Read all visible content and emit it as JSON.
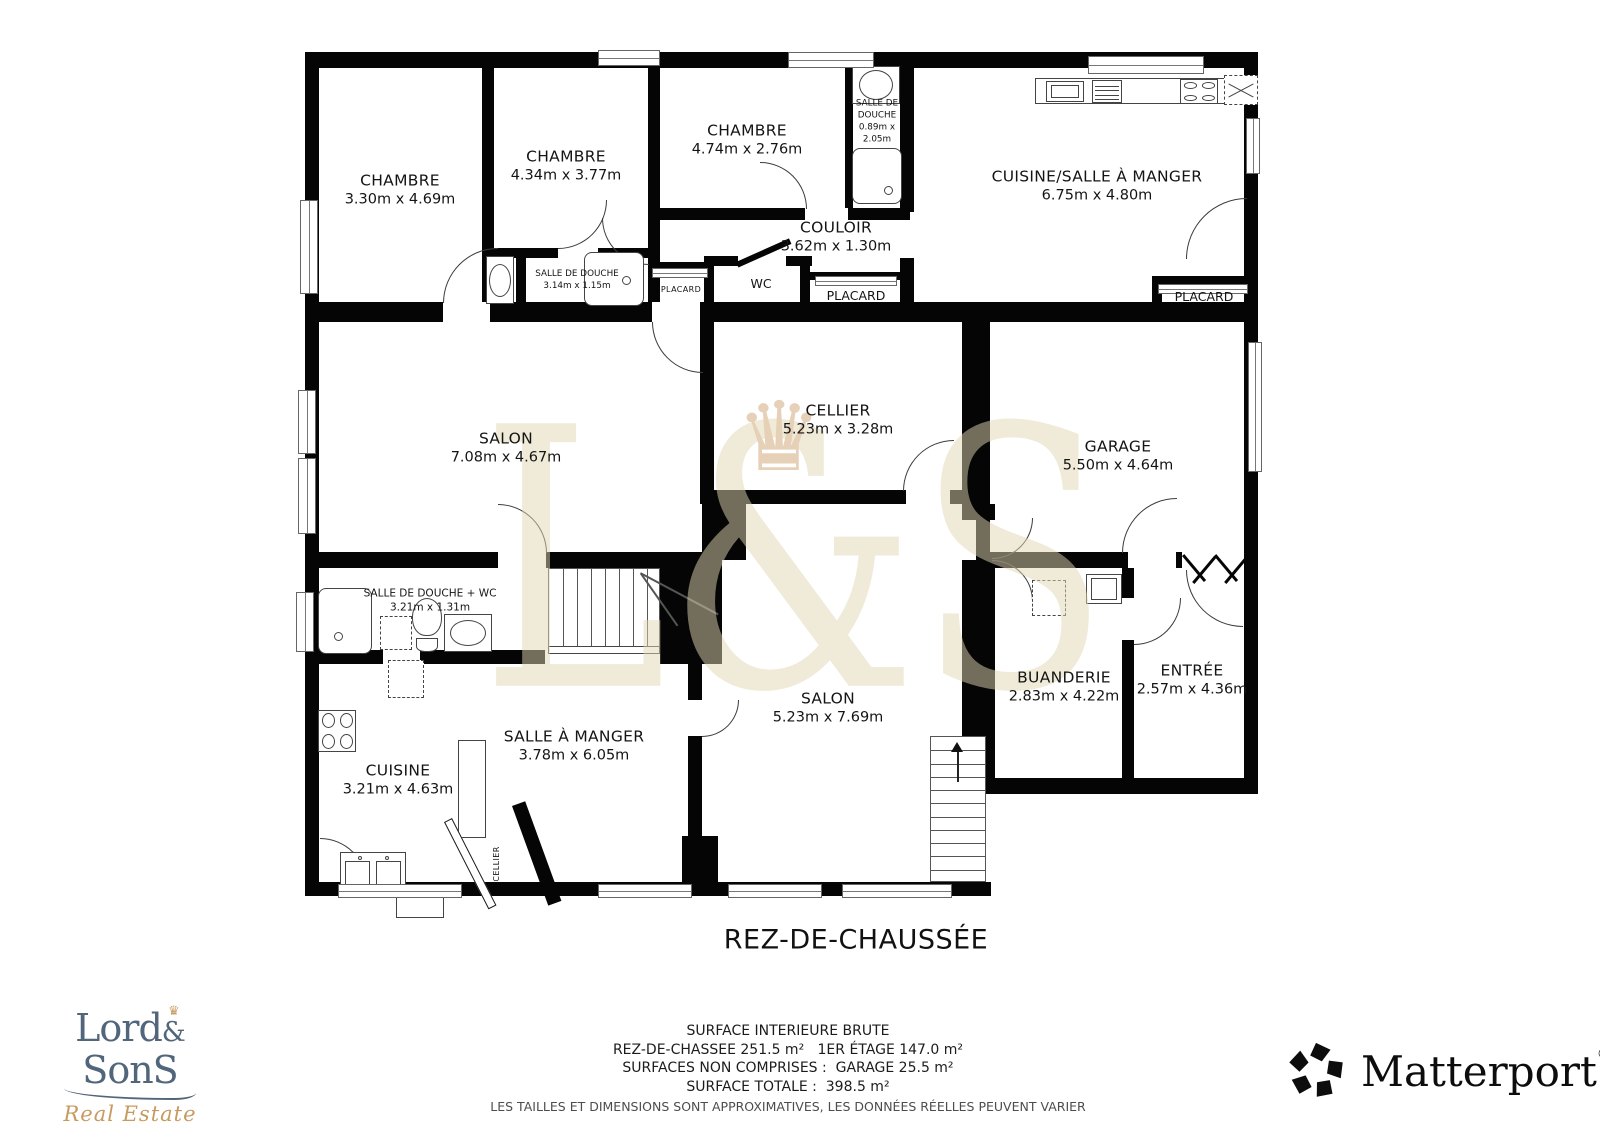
{
  "title": "REZ-DE-CHAUSSÉE",
  "watermark": {
    "text": "L&S",
    "crown_glyph": "♛"
  },
  "footer": {
    "line1": "SURFACE INTERIEURE BRUTE",
    "line2": "REZ-DE-CHASSEE 251.5 m²   1ER ÉTAGE 147.0 m²",
    "line3": "SURFACES NON COMPRISES :  GARAGE 25.5 m²",
    "line4": "SURFACE TOTALE :  398.5 m²",
    "disclaimer": "LES TAILLES ET DIMENSIONS SONT APPROXIMATIVES, LES DONNÉES RÉELLES PEUVENT VARIER"
  },
  "logos": {
    "lordsons": {
      "part1": "Lord",
      "amp": "&",
      "part2": "SonS",
      "tagline": "Real Estate",
      "crown_glyph": "♛",
      "color": "#51657b",
      "gold": "#c79b5f"
    },
    "matterport": {
      "label": "Matterport",
      "reg": "®",
      "color": "#0d0d0d"
    }
  },
  "rooms": [
    {
      "name": "CHAMBRE",
      "dims": "3.30m x 4.69m",
      "x": 400,
      "y": 190,
      "size": "md"
    },
    {
      "name": "CHAMBRE",
      "dims": "4.34m x 3.77m",
      "x": 566,
      "y": 166,
      "size": "md"
    },
    {
      "name": "CHAMBRE",
      "dims": "4.74m x 2.76m",
      "x": 747,
      "y": 140,
      "size": "md"
    },
    {
      "name": "SALLE DE DOUCHE",
      "dims": "0.89m x 2.05m",
      "x": 877,
      "y": 122,
      "size": "xs",
      "w": 56
    },
    {
      "name": "CUISINE/SALLE À MANGER",
      "dims": "6.75m x 4.80m",
      "x": 1097,
      "y": 186,
      "size": "md"
    },
    {
      "name": "COULOIR",
      "dims": "3.62m x 1.30m",
      "x": 836,
      "y": 237,
      "size": "md"
    },
    {
      "name": "WC",
      "dims": "",
      "x": 761,
      "y": 284,
      "size": "sm"
    },
    {
      "name": "PLACARD",
      "dims": "",
      "x": 681,
      "y": 290,
      "size": "xxs"
    },
    {
      "name": "PLACARD",
      "dims": "",
      "x": 856,
      "y": 296,
      "size": "sm"
    },
    {
      "name": "PLACARD",
      "dims": "",
      "x": 1204,
      "y": 297,
      "size": "sm"
    },
    {
      "name": "SALLE DE DOUCHE",
      "dims": "3.14m x 1.15m",
      "x": 577,
      "y": 281,
      "size": "xs"
    },
    {
      "name": "SALON",
      "dims": "7.08m x 4.67m",
      "x": 506,
      "y": 448,
      "size": "md"
    },
    {
      "name": "CELLIER",
      "dims": "5.23m x 3.28m",
      "x": 838,
      "y": 420,
      "size": "md"
    },
    {
      "name": "GARAGE",
      "dims": "5.50m x 4.64m",
      "x": 1118,
      "y": 456,
      "size": "md"
    },
    {
      "name": "SALLE DE DOUCHE + WC",
      "dims": "3.21m x 1.31m",
      "x": 430,
      "y": 601,
      "size": "xsp"
    },
    {
      "name": "CUISINE",
      "dims": "3.21m x 4.63m",
      "x": 398,
      "y": 780,
      "size": "md"
    },
    {
      "name": "SALLE À MANGER",
      "dims": "3.78m x 6.05m",
      "x": 574,
      "y": 746,
      "size": "md"
    },
    {
      "name": "SALON",
      "dims": "5.23m x 7.69m",
      "x": 828,
      "y": 708,
      "size": "md"
    },
    {
      "name": "BUANDERIE",
      "dims": "2.83m x 4.22m",
      "x": 1064,
      "y": 687,
      "size": "md"
    },
    {
      "name": "ENTRÉE",
      "dims": "2.57m x 4.36m",
      "x": 1192,
      "y": 680,
      "size": "md"
    },
    {
      "name": "CELLIER",
      "dims": "",
      "x": 497,
      "y": 864,
      "size": "xxs",
      "rot": -90
    }
  ],
  "plan": {
    "walls": [
      [
        305,
        52,
        953,
        16
      ],
      [
        305,
        52,
        14,
        844
      ],
      [
        1244,
        52,
        14,
        516
      ],
      [
        1244,
        568,
        14,
        226
      ],
      [
        305,
        882,
        686,
        14
      ],
      [
        995,
        778,
        263,
        16
      ],
      [
        305,
        302,
        138,
        20
      ],
      [
        490,
        302,
        162,
        20
      ],
      [
        700,
        302,
        558,
        20
      ],
      [
        482,
        52,
        12,
        250
      ],
      [
        648,
        52,
        12,
        250
      ],
      [
        900,
        52,
        14,
        160
      ],
      [
        900,
        258,
        14,
        44
      ],
      [
        845,
        52,
        8,
        156
      ],
      [
        660,
        208,
        145,
        12
      ],
      [
        848,
        208,
        62,
        12
      ],
      [
        704,
        256,
        34,
        10
      ],
      [
        786,
        256,
        26,
        10
      ],
      [
        704,
        256,
        10,
        50
      ],
      [
        800,
        256,
        10,
        50
      ],
      [
        648,
        262,
        60,
        8
      ],
      [
        810,
        272,
        90,
        8
      ],
      [
        1152,
        276,
        106,
        8
      ],
      [
        1152,
        276,
        10,
        36
      ],
      [
        482,
        248,
        76,
        10
      ],
      [
        598,
        248,
        50,
        10
      ],
      [
        516,
        252,
        10,
        54
      ],
      [
        700,
        322,
        14,
        180
      ],
      [
        962,
        322,
        14,
        182
      ],
      [
        700,
        490,
        206,
        14
      ],
      [
        950,
        490,
        26,
        14
      ],
      [
        976,
        322,
        14,
        246
      ],
      [
        976,
        552,
        152,
        16
      ],
      [
        1176,
        552,
        6,
        16
      ],
      [
        1244,
        552,
        14,
        16
      ],
      [
        702,
        502,
        44,
        58
      ],
      [
        305,
        552,
        193,
        16
      ],
      [
        546,
        552,
        162,
        16
      ],
      [
        676,
        552,
        46,
        112
      ],
      [
        688,
        560,
        14,
        140
      ],
      [
        688,
        736,
        14,
        146
      ],
      [
        682,
        836,
        36,
        46
      ],
      [
        305,
        650,
        78,
        14
      ],
      [
        420,
        650,
        125,
        14
      ],
      [
        660,
        552,
        16,
        112
      ],
      [
        962,
        504,
        33,
        16
      ],
      [
        962,
        560,
        33,
        234
      ],
      [
        962,
        794,
        14,
        88
      ],
      [
        1122,
        568,
        12,
        30
      ],
      [
        1122,
        640,
        12,
        138
      ]
    ],
    "windows": [
      [
        598,
        50,
        60,
        14,
        "h"
      ],
      [
        788,
        52,
        84,
        14,
        "h"
      ],
      [
        1088,
        56,
        114,
        16,
        "h"
      ],
      [
        300,
        200,
        16,
        92,
        "v"
      ],
      [
        298,
        390,
        16,
        62,
        "v"
      ],
      [
        298,
        458,
        16,
        74,
        "v"
      ],
      [
        1246,
        118,
        12,
        54,
        "v"
      ],
      [
        1248,
        342,
        12,
        128,
        "v"
      ],
      [
        338,
        884,
        122,
        12,
        "h"
      ],
      [
        598,
        884,
        92,
        12,
        "h"
      ],
      [
        728,
        884,
        92,
        12,
        "h"
      ],
      [
        842,
        884,
        108,
        12,
        "h"
      ],
      [
        296,
        592,
        16,
        58,
        "v"
      ],
      [
        652,
        268,
        54,
        8,
        "h"
      ],
      [
        815,
        276,
        80,
        8,
        "h"
      ],
      [
        1158,
        284,
        88,
        8,
        "h"
      ]
    ],
    "doors": [
      [
        443,
        248,
        54,
        "tl"
      ],
      [
        558,
        200,
        48,
        "br"
      ],
      [
        760,
        162,
        46,
        "tr"
      ],
      [
        602,
        218,
        46,
        "bl"
      ],
      [
        1186,
        198,
        60,
        "tl"
      ],
      [
        903,
        440,
        50,
        "tl"
      ],
      [
        1122,
        498,
        54,
        "tl"
      ],
      [
        498,
        504,
        48,
        "tr"
      ],
      [
        992,
        518,
        40,
        "br"
      ],
      [
        992,
        560,
        40,
        "tr"
      ],
      [
        1186,
        570,
        56,
        "bl"
      ],
      [
        1134,
        598,
        46,
        "br"
      ],
      [
        320,
        838,
        46,
        "tr"
      ],
      [
        702,
        700,
        36,
        "br"
      ],
      [
        652,
        322,
        50,
        "bl"
      ]
    ],
    "leaves": [
      [
        736,
        262,
        58,
        6,
        -24,
        "b"
      ],
      [
        512,
        806,
        14,
        106,
        -20,
        "b"
      ],
      [
        452,
        818,
        96,
        7,
        63,
        "o"
      ],
      [
        640,
        574,
        2,
        64,
        -35,
        "g"
      ],
      [
        640,
        574,
        2,
        88,
        -62,
        "g"
      ],
      [
        1182,
        556,
        3,
        34,
        -40,
        "b"
      ],
      [
        1214,
        556,
        3,
        34,
        40,
        "b"
      ],
      [
        1214,
        556,
        3,
        34,
        -40,
        "b"
      ],
      [
        1246,
        556,
        3,
        34,
        40,
        "b"
      ]
    ],
    "stairs": [
      {
        "x": 548,
        "y": 568,
        "w": 112,
        "h": 80,
        "dir": "v",
        "treads": 7
      },
      {
        "x": 930,
        "y": 736,
        "w": 56,
        "h": 146,
        "dir": "h",
        "treads": 10
      }
    ],
    "fixtures": [
      [
        "rect",
        1035,
        78,
        212,
        26
      ],
      [
        "washer",
        1046,
        81,
        38,
        21
      ],
      [
        "grill",
        1092,
        80,
        30,
        23
      ],
      [
        "hob",
        1180,
        79,
        38,
        25
      ],
      [
        "dashedx",
        1224,
        75,
        34,
        30
      ],
      [
        "rect",
        852,
        66,
        48,
        38
      ],
      [
        "ellipse",
        859,
        70,
        34,
        30
      ],
      [
        "rrect",
        852,
        148,
        50,
        56
      ],
      [
        "circle",
        884,
        186,
        9,
        9
      ],
      [
        "rect",
        486,
        256,
        28,
        48
      ],
      [
        "ellipse",
        489,
        264,
        22,
        33
      ],
      [
        "rrect",
        584,
        252,
        60,
        54
      ],
      [
        "circle",
        622,
        276,
        9,
        9
      ],
      [
        "rrect",
        318,
        588,
        54,
        66
      ],
      [
        "circle",
        334,
        632,
        9,
        9
      ],
      [
        "dashed",
        380,
        616,
        32,
        34
      ],
      [
        "toilet",
        412,
        598,
        30,
        54
      ],
      [
        "rect",
        444,
        614,
        48,
        38
      ],
      [
        "ellipse",
        450,
        620,
        36,
        26
      ],
      [
        "dashed",
        1032,
        580,
        34,
        36
      ],
      [
        "washer",
        1086,
        574,
        36,
        30
      ],
      [
        "hob",
        318,
        710,
        38,
        42
      ],
      [
        "rect",
        458,
        740,
        28,
        98
      ],
      [
        "sink2",
        340,
        852,
        66,
        40
      ],
      [
        "dashed",
        388,
        660,
        36,
        38
      ],
      [
        "rect",
        396,
        896,
        48,
        22
      ],
      [
        "rect",
        548,
        646,
        112,
        8
      ],
      [
        "arrow",
        950,
        742,
        14,
        40
      ]
    ]
  }
}
